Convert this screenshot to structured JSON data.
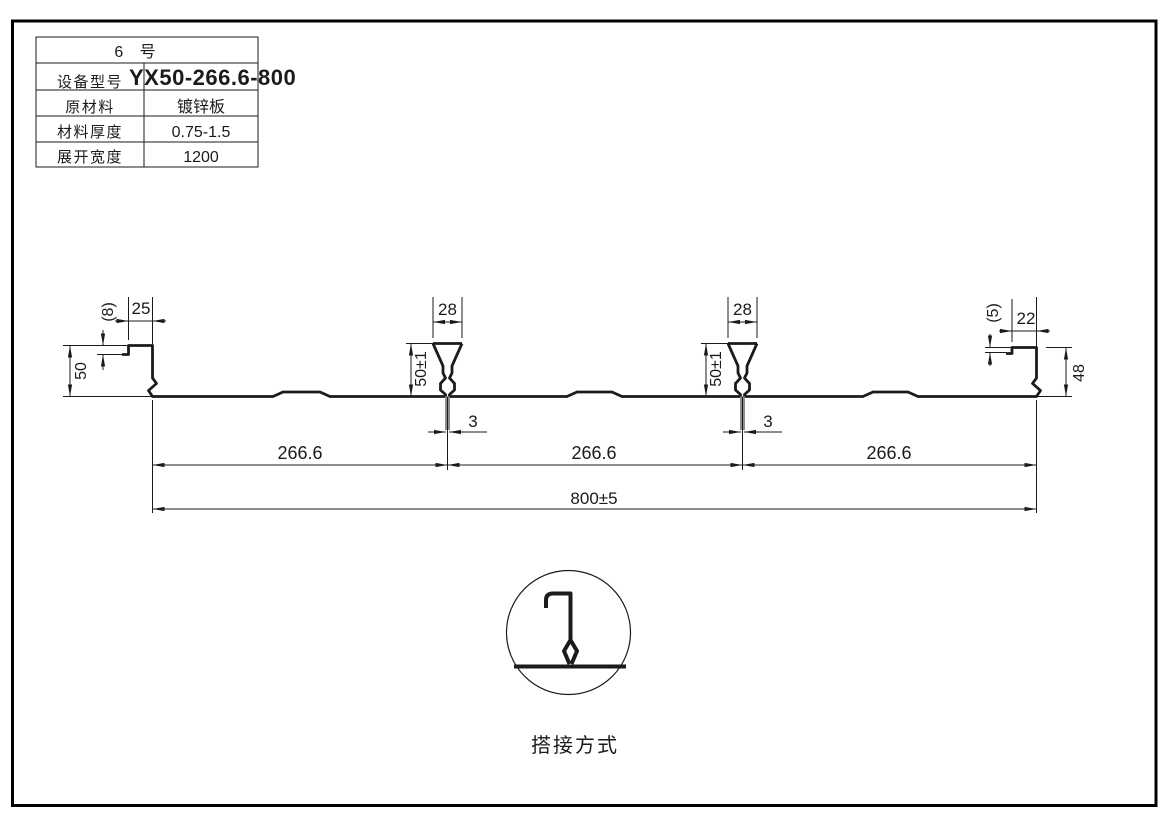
{
  "table": {
    "title": "6  号",
    "rows": [
      {
        "label": "设备型号",
        "value": "YX50-266.6-800"
      },
      {
        "label": "原材料",
        "value": "镀锌板"
      },
      {
        "label": "材料厚度",
        "value": "0.75-1.5"
      },
      {
        "label": "展开宽度",
        "value": "1200"
      }
    ]
  },
  "dims": {
    "left_step": "(8)",
    "left_top": "25",
    "left_height": "50",
    "rib_top_width": "28",
    "rib_height": "50±1",
    "rib_slot": "3",
    "right_step": "(5)",
    "right_top": "22",
    "right_height": "48",
    "pitch": "266.6",
    "overall": "800±5"
  },
  "detail": {
    "caption": "搭接方式"
  },
  "colors": {
    "line": "#1b1b1b",
    "background": "#ffffff"
  }
}
